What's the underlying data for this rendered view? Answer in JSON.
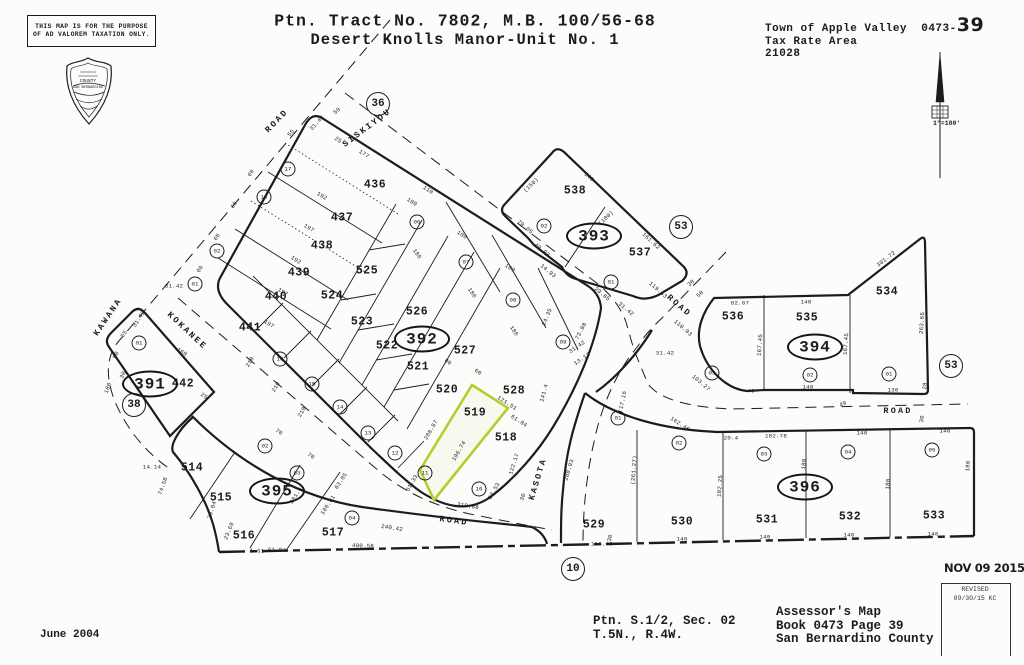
{
  "header": {
    "disclaimer_line1": "THIS MAP IS FOR THE PURPOSE",
    "disclaimer_line2": "OF AD VALOREM TAXATION ONLY.",
    "title_line1": "Ptn. Tract No. 7802, M.B. 100/56-68",
    "title_line2": "Desert Knolls Manor-Unit No. 1",
    "jurisdiction": "Town of Apple Valley",
    "book_prefix": "0473-",
    "page_number": "39",
    "tax_rate_area_label": "Tax Rate Area",
    "tax_rate_area_value": "21028",
    "scale": "1\"=100'",
    "seal_line1": "COUNTY",
    "seal_line2": "SAN BERNARDINO"
  },
  "footer": {
    "date": "June 2004",
    "section_line1": "Ptn. S.1/2, Sec. 02",
    "section_line2": "T.5N., R.4W.",
    "assessor_line1": "Assessor's Map",
    "assessor_line2": "Book 0473 Page 39",
    "assessor_line3": "San Bernardino County",
    "stamp_date": "NOV 09 2015",
    "revised_label": "REVISED",
    "revised_value": "09/30/15 KC"
  },
  "map": {
    "highlighted_parcel": "519",
    "highlight_color": "#b9cc2e",
    "line_color": "#1c1c1c",
    "block_ellipses": [
      {
        "t": "391",
        "x": 150,
        "y": 384
      },
      {
        "t": "392",
        "x": 422,
        "y": 339
      },
      {
        "t": "393",
        "x": 594,
        "y": 236
      },
      {
        "t": "394",
        "x": 815,
        "y": 347
      },
      {
        "t": "395",
        "x": 277,
        "y": 491
      },
      {
        "t": "396",
        "x": 805,
        "y": 487
      }
    ],
    "big_circles": [
      {
        "t": "36",
        "x": 378,
        "y": 104
      },
      {
        "t": "53",
        "x": 681,
        "y": 227
      },
      {
        "t": "53",
        "x": 951,
        "y": 366
      },
      {
        "t": "38",
        "x": 134,
        "y": 405
      },
      {
        "t": "10",
        "x": 573,
        "y": 569
      }
    ],
    "parcels": [
      {
        "t": "436",
        "x": 375,
        "y": 185
      },
      {
        "t": "437",
        "x": 342,
        "y": 218
      },
      {
        "t": "438",
        "x": 322,
        "y": 246
      },
      {
        "t": "439",
        "x": 299,
        "y": 273
      },
      {
        "t": "440",
        "x": 276,
        "y": 297
      },
      {
        "t": "441",
        "x": 250,
        "y": 328
      },
      {
        "t": "442",
        "x": 183,
        "y": 384
      },
      {
        "t": "525",
        "x": 367,
        "y": 271
      },
      {
        "t": "524",
        "x": 332,
        "y": 296
      },
      {
        "t": "523",
        "x": 362,
        "y": 322
      },
      {
        "t": "522",
        "x": 387,
        "y": 346
      },
      {
        "t": "521",
        "x": 418,
        "y": 367
      },
      {
        "t": "520",
        "x": 447,
        "y": 390
      },
      {
        "t": "519",
        "x": 475,
        "y": 413
      },
      {
        "t": "518",
        "x": 506,
        "y": 438
      },
      {
        "t": "526",
        "x": 417,
        "y": 312
      },
      {
        "t": "527",
        "x": 465,
        "y": 351
      },
      {
        "t": "528",
        "x": 514,
        "y": 391
      },
      {
        "t": "538",
        "x": 575,
        "y": 191
      },
      {
        "t": "537",
        "x": 640,
        "y": 253
      },
      {
        "t": "536",
        "x": 733,
        "y": 317
      },
      {
        "t": "535",
        "x": 807,
        "y": 318
      },
      {
        "t": "534",
        "x": 887,
        "y": 292
      },
      {
        "t": "514",
        "x": 192,
        "y": 468
      },
      {
        "t": "515",
        "x": 221,
        "y": 498
      },
      {
        "t": "516",
        "x": 244,
        "y": 536
      },
      {
        "t": "517",
        "x": 333,
        "y": 533
      },
      {
        "t": "529",
        "x": 594,
        "y": 525
      },
      {
        "t": "530",
        "x": 682,
        "y": 522
      },
      {
        "t": "531",
        "x": 767,
        "y": 520
      },
      {
        "t": "532",
        "x": 850,
        "y": 517
      },
      {
        "t": "533",
        "x": 934,
        "y": 516
      }
    ],
    "lot_circles": [
      {
        "t": "17",
        "x": 288,
        "y": 169
      },
      {
        "t": "18",
        "x": 264,
        "y": 197
      },
      {
        "t": "02",
        "x": 217,
        "y": 251
      },
      {
        "t": "01",
        "x": 195,
        "y": 284
      },
      {
        "t": "01",
        "x": 139,
        "y": 343
      },
      {
        "t": "06",
        "x": 417,
        "y": 222
      },
      {
        "t": "07",
        "x": 466,
        "y": 262
      },
      {
        "t": "08",
        "x": 513,
        "y": 300
      },
      {
        "t": "09",
        "x": 563,
        "y": 342
      },
      {
        "t": "16",
        "x": 280,
        "y": 359
      },
      {
        "t": "15",
        "x": 312,
        "y": 384
      },
      {
        "t": "14",
        "x": 340,
        "y": 407
      },
      {
        "t": "13",
        "x": 368,
        "y": 433
      },
      {
        "t": "12",
        "x": 395,
        "y": 453
      },
      {
        "t": "11",
        "x": 425,
        "y": 473
      },
      {
        "t": "10",
        "x": 479,
        "y": 489
      },
      {
        "t": "02",
        "x": 544,
        "y": 226
      },
      {
        "t": "01",
        "x": 611,
        "y": 282
      },
      {
        "t": "03",
        "x": 712,
        "y": 373
      },
      {
        "t": "02",
        "x": 810,
        "y": 375
      },
      {
        "t": "01",
        "x": 889,
        "y": 374
      },
      {
        "t": "02",
        "x": 265,
        "y": 446
      },
      {
        "t": "03",
        "x": 297,
        "y": 473
      },
      {
        "t": "04",
        "x": 352,
        "y": 518
      },
      {
        "t": "01",
        "x": 618,
        "y": 418
      },
      {
        "t": "02",
        "x": 679,
        "y": 443
      },
      {
        "t": "03",
        "x": 764,
        "y": 454
      },
      {
        "t": "04",
        "x": 848,
        "y": 452
      },
      {
        "t": "05",
        "x": 932,
        "y": 450
      }
    ],
    "road_labels": [
      {
        "t": "ROAD",
        "x": 277,
        "y": 121,
        "r": -46
      },
      {
        "t": "SISKIYOU",
        "x": 367,
        "y": 128,
        "r": -37
      },
      {
        "t": "KAWANA",
        "x": 108,
        "y": 317,
        "r": -56
      },
      {
        "t": "KOKANEE",
        "x": 187,
        "y": 331,
        "r": 43
      },
      {
        "t": "KASOTA",
        "x": 538,
        "y": 479,
        "r": -73
      },
      {
        "t": "ROAD",
        "x": 454,
        "y": 521,
        "r": 8
      },
      {
        "t": "ROAD",
        "x": 898,
        "y": 411,
        "r": 0
      },
      {
        "t": "ROAD",
        "x": 679,
        "y": 306,
        "r": 41
      }
    ],
    "dims": [
      {
        "t": "55",
        "x": 291,
        "y": 133,
        "r": -47
      },
      {
        "t": "31.42",
        "x": 317,
        "y": 123,
        "r": -47
      },
      {
        "t": "50",
        "x": 337,
        "y": 111,
        "r": -40
      },
      {
        "t": "60",
        "x": 251,
        "y": 173,
        "r": -57
      },
      {
        "t": "60",
        "x": 234,
        "y": 205,
        "r": -57
      },
      {
        "t": "60",
        "x": 217,
        "y": 237,
        "r": -57
      },
      {
        "t": "60",
        "x": 200,
        "y": 269,
        "r": -57
      },
      {
        "t": "25",
        "x": 338,
        "y": 140,
        "r": 33
      },
      {
        "t": "177",
        "x": 364,
        "y": 154,
        "r": 33
      },
      {
        "t": "192",
        "x": 322,
        "y": 196,
        "r": 31
      },
      {
        "t": "197",
        "x": 309,
        "y": 228,
        "r": 31
      },
      {
        "t": "192",
        "x": 296,
        "y": 260,
        "r": 31
      },
      {
        "t": "197",
        "x": 283,
        "y": 292,
        "r": 31
      },
      {
        "t": "197",
        "x": 269,
        "y": 324,
        "r": 31
      },
      {
        "t": "110",
        "x": 428,
        "y": 190,
        "r": 33
      },
      {
        "t": "100",
        "x": 412,
        "y": 202,
        "r": 33
      },
      {
        "t": "100",
        "x": 462,
        "y": 235,
        "r": 33
      },
      {
        "t": "100",
        "x": 510,
        "y": 268,
        "r": 33
      },
      {
        "t": "180",
        "x": 417,
        "y": 254,
        "r": 56
      },
      {
        "t": "180",
        "x": 472,
        "y": 293,
        "r": 56
      },
      {
        "t": "180",
        "x": 514,
        "y": 331,
        "r": 56
      },
      {
        "t": "210",
        "x": 250,
        "y": 362,
        "r": -60
      },
      {
        "t": "210",
        "x": 276,
        "y": 387,
        "r": -60
      },
      {
        "t": "210",
        "x": 302,
        "y": 412,
        "r": -60
      },
      {
        "t": "60",
        "x": 478,
        "y": 372,
        "r": 33
      },
      {
        "t": "80",
        "x": 448,
        "y": 362,
        "r": 33
      },
      {
        "t": "208.87",
        "x": 431,
        "y": 430,
        "r": -60
      },
      {
        "t": "196.74",
        "x": 459,
        "y": 451,
        "r": -60
      },
      {
        "t": "121.51",
        "x": 507,
        "y": 403,
        "r": 33
      },
      {
        "t": "61.04",
        "x": 519,
        "y": 421,
        "r": 33
      },
      {
        "t": "61.33",
        "x": 412,
        "y": 483,
        "r": -60
      },
      {
        "t": "122.17",
        "x": 514,
        "y": 464,
        "r": -72
      },
      {
        "t": "23.53",
        "x": 494,
        "y": 491,
        "r": -60
      },
      {
        "t": "310.88",
        "x": 468,
        "y": 506,
        "r": 9
      },
      {
        "t": "70",
        "x": 279,
        "y": 432,
        "r": 33
      },
      {
        "t": "70",
        "x": 311,
        "y": 456,
        "r": 33
      },
      {
        "t": "63.05",
        "x": 341,
        "y": 481,
        "r": -57
      },
      {
        "t": "201.57",
        "x": 297,
        "y": 494,
        "r": -57
      },
      {
        "t": "180.81",
        "x": 328,
        "y": 505,
        "r": -57
      },
      {
        "t": "240.42",
        "x": 392,
        "y": 528,
        "r": 9
      },
      {
        "t": "400.58",
        "x": 363,
        "y": 546,
        "r": 2
      },
      {
        "t": "61.84",
        "x": 277,
        "y": 550,
        "r": 2
      },
      {
        "t": "1.61",
        "x": 257,
        "y": 551,
        "r": 2
      },
      {
        "t": "23.69",
        "x": 229,
        "y": 531,
        "r": -68
      },
      {
        "t": "20.04",
        "x": 212,
        "y": 510,
        "r": -72
      },
      {
        "t": "14.14",
        "x": 152,
        "y": 467,
        "r": 0
      },
      {
        "t": "74.58",
        "x": 163,
        "y": 486,
        "r": -70
      },
      {
        "t": "180",
        "x": 108,
        "y": 388,
        "r": -70
      },
      {
        "t": "160",
        "x": 182,
        "y": 352,
        "r": 33
      },
      {
        "t": "25",
        "x": 204,
        "y": 396,
        "r": 33
      },
      {
        "t": "31.42",
        "x": 174,
        "y": 286,
        "r": 0
      },
      {
        "t": "31.42",
        "x": 139,
        "y": 319,
        "r": -57
      },
      {
        "t": "55",
        "x": 124,
        "y": 334,
        "r": -57
      },
      {
        "t": "50",
        "x": 116,
        "y": 355,
        "r": -65
      },
      {
        "t": "30",
        "x": 123,
        "y": 375,
        "r": -65
      },
      {
        "t": "24.35",
        "x": 547,
        "y": 317,
        "r": -68
      },
      {
        "t": "73.88",
        "x": 581,
        "y": 331,
        "r": -62
      },
      {
        "t": "31.42",
        "x": 577,
        "y": 347,
        "r": -35
      },
      {
        "t": "13.12",
        "x": 582,
        "y": 359,
        "r": -35
      },
      {
        "t": "29.85",
        "x": 602,
        "y": 294,
        "r": 40
      },
      {
        "t": "31.42",
        "x": 626,
        "y": 309,
        "r": 40
      },
      {
        "t": "119.63",
        "x": 658,
        "y": 290,
        "r": 41
      },
      {
        "t": "110.03",
        "x": 683,
        "y": 328,
        "r": 41
      },
      {
        "t": "31.42",
        "x": 665,
        "y": 353,
        "r": 0
      },
      {
        "t": "141.4",
        "x": 544,
        "y": 393,
        "r": -75
      },
      {
        "t": "17.16",
        "x": 623,
        "y": 400,
        "r": -78
      },
      {
        "t": "103.27",
        "x": 701,
        "y": 383,
        "r": 40
      },
      {
        "t": "162.46",
        "x": 680,
        "y": 424,
        "r": 33
      },
      {
        "t": "(150)",
        "x": 531,
        "y": 185,
        "r": -43
      },
      {
        "t": "140",
        "x": 589,
        "y": 177,
        "r": 41
      },
      {
        "t": "(100)",
        "x": 606,
        "y": 218,
        "r": -43
      },
      {
        "t": "79.05",
        "x": 525,
        "y": 227,
        "r": 40
      },
      {
        "t": "40.93",
        "x": 542,
        "y": 250,
        "r": 40
      },
      {
        "t": "14.93",
        "x": 548,
        "y": 271,
        "r": 40
      },
      {
        "t": "161.62",
        "x": 651,
        "y": 241,
        "r": 43
      },
      {
        "t": "82.67",
        "x": 740,
        "y": 303,
        "r": 0
      },
      {
        "t": "140",
        "x": 806,
        "y": 302,
        "r": 0
      },
      {
        "t": "301.72",
        "x": 886,
        "y": 259,
        "r": -38
      },
      {
        "t": "263.65",
        "x": 922,
        "y": 323,
        "r": -86
      },
      {
        "t": "167.45",
        "x": 760,
        "y": 345,
        "r": -86
      },
      {
        "t": "167.45",
        "x": 846,
        "y": 344,
        "r": -86
      },
      {
        "t": "30",
        "x": 691,
        "y": 283,
        "r": -43
      },
      {
        "t": "50",
        "x": 700,
        "y": 294,
        "r": -43
      },
      {
        "t": "140",
        "x": 808,
        "y": 387,
        "r": 0
      },
      {
        "t": "130",
        "x": 893,
        "y": 390,
        "r": 0
      },
      {
        "t": "40",
        "x": 751,
        "y": 391,
        "r": 0
      },
      {
        "t": "28",
        "x": 925,
        "y": 386,
        "r": -86
      },
      {
        "t": "49",
        "x": 843,
        "y": 404,
        "r": -25
      },
      {
        "t": "30",
        "x": 922,
        "y": 419,
        "r": -80
      },
      {
        "t": "20.4",
        "x": 731,
        "y": 438,
        "r": 0
      },
      {
        "t": "102.78",
        "x": 776,
        "y": 436,
        "r": 0
      },
      {
        "t": "140",
        "x": 862,
        "y": 433,
        "r": 0
      },
      {
        "t": "140",
        "x": 945,
        "y": 431,
        "r": 0
      },
      {
        "t": "(261.27)",
        "x": 634,
        "y": 470,
        "r": -86
      },
      {
        "t": "182.25",
        "x": 720,
        "y": 486,
        "r": -86
      },
      {
        "t": "180",
        "x": 804,
        "y": 464,
        "r": -86
      },
      {
        "t": "180",
        "x": 888,
        "y": 484,
        "r": -86
      },
      {
        "t": "180",
        "x": 968,
        "y": 466,
        "r": -86
      },
      {
        "t": "140",
        "x": 682,
        "y": 539,
        "r": 0
      },
      {
        "t": "140",
        "x": 765,
        "y": 537,
        "r": 0
      },
      {
        "t": "140",
        "x": 849,
        "y": 535,
        "r": 0
      },
      {
        "t": "140",
        "x": 933,
        "y": 534,
        "r": 0
      },
      {
        "t": "156.49",
        "x": 602,
        "y": 544,
        "r": 0
      },
      {
        "t": "288.93",
        "x": 569,
        "y": 470,
        "r": -73
      },
      {
        "t": "30",
        "x": 523,
        "y": 497,
        "r": -70
      },
      {
        "t": "30",
        "x": 610,
        "y": 538,
        "r": -78
      }
    ]
  }
}
